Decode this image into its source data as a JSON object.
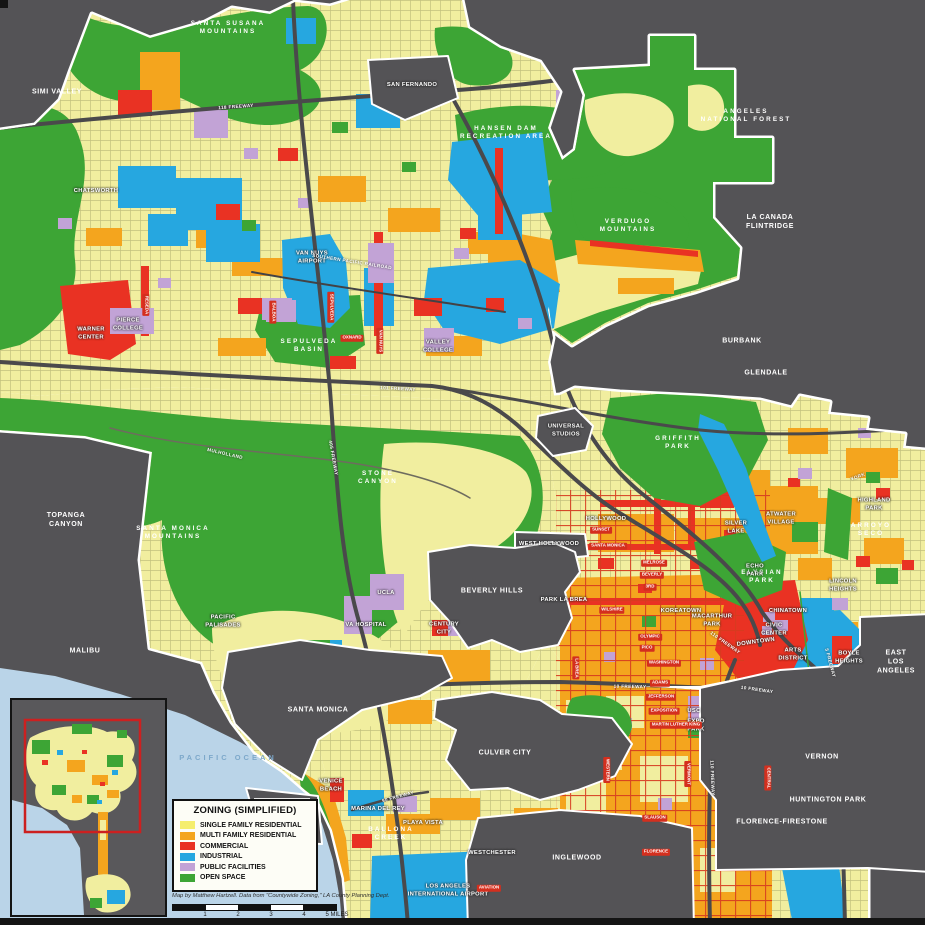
{
  "colors": {
    "background": "#545356",
    "single_family": "#f1ee9f",
    "multi_family": "#f4a51e",
    "commercial": "#e93223",
    "industrial": "#26a7e0",
    "public_facilities": "#c2a3d6",
    "open_space": "#3da535",
    "ocean": "#bad4e8",
    "boundary": "#ffffff",
    "freeway": "#4a494b",
    "inset_viewport": "#cc2020"
  },
  "legend": {
    "title": "ZONING (SIMPLIFIED)",
    "items": [
      {
        "label": "SINGLE FAMILY RESIDENTIAL",
        "color": "#f5ee6e"
      },
      {
        "label": "MULTI FAMILY RESIDENTIAL",
        "color": "#f4a51e"
      },
      {
        "label": "COMMERCIAL",
        "color": "#e93223"
      },
      {
        "label": "INDUSTRIAL",
        "color": "#26a7e0"
      },
      {
        "label": "PUBLIC FACILITIES",
        "color": "#c2a3d6"
      },
      {
        "label": "OPEN SPACE",
        "color": "#3da535"
      }
    ]
  },
  "credit": "Map by Matthew Hartzell. Data from \"Countywide Zoning,\" LA County Planning Dept.",
  "scalebar": {
    "ticks": [
      "1",
      "2",
      "3",
      "4",
      "5 MILES"
    ]
  },
  "map": {
    "labels": [
      {
        "t": "SIMI VALLEY",
        "x": 57,
        "y": 92,
        "c": "city"
      },
      {
        "t": "SAN FERNANDO",
        "x": 412,
        "y": 86,
        "c": "place"
      },
      {
        "t": "LA CANADA\nFLINTRIDGE",
        "x": 770,
        "y": 222,
        "c": "city"
      },
      {
        "t": "BURBANK",
        "x": 742,
        "y": 341,
        "c": "city"
      },
      {
        "t": "GLENDALE",
        "x": 766,
        "y": 373,
        "c": "city"
      },
      {
        "t": "TOPANGA\nCANYON",
        "x": 66,
        "y": 520,
        "c": "city"
      },
      {
        "t": "MALIBU",
        "x": 85,
        "y": 651,
        "c": "city"
      },
      {
        "t": "SANTA MONICA",
        "x": 318,
        "y": 710,
        "c": "city"
      },
      {
        "t": "CULVER CITY",
        "x": 505,
        "y": 753,
        "c": "city"
      },
      {
        "t": "INGLEWOOD",
        "x": 577,
        "y": 858,
        "c": "city"
      },
      {
        "t": "VERNON",
        "x": 822,
        "y": 757,
        "c": "city"
      },
      {
        "t": "HUNTINGTON PARK",
        "x": 828,
        "y": 800,
        "c": "city"
      },
      {
        "t": "FLORENCE-FIRESTONE",
        "x": 782,
        "y": 822,
        "c": "city"
      },
      {
        "t": "EAST\nLOS ANGELES",
        "x": 896,
        "y": 662,
        "c": "city"
      },
      {
        "t": "BEVERLY HILLS",
        "x": 492,
        "y": 591,
        "c": "city"
      },
      {
        "t": "WEST HOLLYWOOD",
        "x": 549,
        "y": 545,
        "c": "place"
      },
      {
        "t": "UNIVERSAL\nSTUDIOS",
        "x": 566,
        "y": 431,
        "c": "place"
      },
      {
        "t": "SANTA SUSANA\nMOUNTAINS",
        "x": 228,
        "y": 28,
        "c": "green"
      },
      {
        "t": "HANSEN DAM\nRECREATION AREA",
        "x": 506,
        "y": 133,
        "c": "green"
      },
      {
        "t": "ANGELES\nNATIONAL FOREST",
        "x": 746,
        "y": 116,
        "c": "green"
      },
      {
        "t": "VERDUGO\nMOUNTAINS",
        "x": 628,
        "y": 226,
        "c": "green"
      },
      {
        "t": "GRIFFITH\nPARK",
        "x": 678,
        "y": 443,
        "c": "green"
      },
      {
        "t": "SANTA MONICA\nMOUNTAINS",
        "x": 173,
        "y": 533,
        "c": "green"
      },
      {
        "t": "SEPULVEDA\nBASIN",
        "x": 309,
        "y": 346,
        "c": "green"
      },
      {
        "t": "STONE\nCANYON",
        "x": 378,
        "y": 478,
        "c": "green"
      },
      {
        "t": "ELYSIAN\nPARK",
        "x": 762,
        "y": 577,
        "c": "green"
      },
      {
        "t": "ARROYO\nSECO",
        "x": 871,
        "y": 530,
        "c": "green"
      },
      {
        "t": "BALLONA\nCREEK",
        "x": 391,
        "y": 834,
        "c": "green"
      },
      {
        "t": "PACIFIC OCEAN",
        "x": 228,
        "y": 758,
        "c": "ocean"
      },
      {
        "t": "CHATSWORTH",
        "x": 96,
        "y": 192,
        "c": "place"
      },
      {
        "t": "VAN NUYS\nAIRPORT",
        "x": 312,
        "y": 258,
        "c": "place"
      },
      {
        "t": "WARNER\nCENTER",
        "x": 91,
        "y": 334,
        "c": "place"
      },
      {
        "t": "PIERCE\nCOLLEGE",
        "x": 128,
        "y": 325,
        "c": "place"
      },
      {
        "t": "VALLEY\nCOLLEGE",
        "x": 438,
        "y": 347,
        "c": "place"
      },
      {
        "t": "PACIFIC\nPALISADES",
        "x": 223,
        "y": 622,
        "c": "place"
      },
      {
        "t": "UCLA",
        "x": 386,
        "y": 594,
        "c": "place"
      },
      {
        "t": "VA HOSPITAL",
        "x": 366,
        "y": 626,
        "c": "place"
      },
      {
        "t": "CENTURY\nCITY",
        "x": 444,
        "y": 629,
        "c": "place"
      },
      {
        "t": "HOLLYWOOD",
        "x": 606,
        "y": 520,
        "c": "place"
      },
      {
        "t": "SILVER\nLAKE",
        "x": 736,
        "y": 528,
        "c": "place"
      },
      {
        "t": "ATWATER\nVILLAGE",
        "x": 781,
        "y": 519,
        "c": "place"
      },
      {
        "t": "ECHO\nPARK",
        "x": 755,
        "y": 571,
        "c": "place"
      },
      {
        "t": "HIGHLAND\nPARK",
        "x": 874,
        "y": 505,
        "c": "place"
      },
      {
        "t": "LINCOLN\nHEIGHTS",
        "x": 843,
        "y": 586,
        "c": "place"
      },
      {
        "t": "KOREATOWN",
        "x": 681,
        "y": 612,
        "c": "place"
      },
      {
        "t": "MACARTHUR\nPARK",
        "x": 712,
        "y": 621,
        "c": "place"
      },
      {
        "t": "PARK LA BREA",
        "x": 564,
        "y": 601,
        "c": "place"
      },
      {
        "t": "CIVIC\nCENTER",
        "x": 774,
        "y": 630,
        "c": "place"
      },
      {
        "t": "DOWNTOWN",
        "x": 756,
        "y": 643,
        "c": "place",
        "r": -8
      },
      {
        "t": "CHINATOWN",
        "x": 788,
        "y": 612,
        "c": "place"
      },
      {
        "t": "ARTS\nDISTRICT",
        "x": 793,
        "y": 655,
        "c": "place"
      },
      {
        "t": "BOYLE\nHEIGHTS",
        "x": 849,
        "y": 658,
        "c": "place"
      },
      {
        "t": "USC",
        "x": 694,
        "y": 712,
        "c": "place"
      },
      {
        "t": "EXPO\nPARK",
        "x": 696,
        "y": 726,
        "c": "place"
      },
      {
        "t": "VENICE\nBEACH",
        "x": 331,
        "y": 786,
        "c": "place"
      },
      {
        "t": "MARINA DEL REY",
        "x": 378,
        "y": 810,
        "c": "place"
      },
      {
        "t": "PLAYA VISTA",
        "x": 423,
        "y": 824,
        "c": "place"
      },
      {
        "t": "WESTCHESTER",
        "x": 492,
        "y": 854,
        "c": "place"
      },
      {
        "t": "LOS ANGELES\nINTERNATIONAL AIRPORT",
        "x": 448,
        "y": 891,
        "c": "place"
      },
      {
        "t": "118 FREEWAY",
        "x": 236,
        "y": 107,
        "c": "road",
        "r": -4
      },
      {
        "t": "SOUTHERN PACIFIC RAILROAD",
        "x": 352,
        "y": 262,
        "c": "road",
        "r": 9
      },
      {
        "t": "101 FREEWAY",
        "x": 398,
        "y": 389,
        "c": "road",
        "r": 3
      },
      {
        "t": "405 FREEWAY",
        "x": 333,
        "y": 458,
        "c": "road",
        "r": 80
      },
      {
        "t": "MULHOLLAND",
        "x": 225,
        "y": 454,
        "c": "road",
        "r": 13
      },
      {
        "t": "10 FREEWAY",
        "x": 630,
        "y": 687,
        "c": "road",
        "r": 1
      },
      {
        "t": "10 FREEWAY",
        "x": 757,
        "y": 690,
        "c": "road",
        "r": 8
      },
      {
        "t": "110 FREEWAY",
        "x": 725,
        "y": 643,
        "c": "road",
        "r": 35
      },
      {
        "t": "110 FREEWAY",
        "x": 712,
        "y": 778,
        "c": "road",
        "r": 88
      },
      {
        "t": "5 FREEWAY",
        "x": 830,
        "y": 663,
        "c": "road",
        "r": 75
      },
      {
        "t": "90 FREEWAY",
        "x": 398,
        "y": 797,
        "c": "road",
        "r": -15
      },
      {
        "t": "YORK",
        "x": 858,
        "y": 477,
        "c": "road",
        "r": -20
      },
      {
        "t": "OXNARD",
        "x": 352,
        "y": 338,
        "c": "street"
      },
      {
        "t": "BALBOA",
        "x": 273,
        "y": 312,
        "c": "street",
        "r": 90
      },
      {
        "t": "SEPULVEDA",
        "x": 331,
        "y": 307,
        "c": "street",
        "r": 90
      },
      {
        "t": "VAN NUYS",
        "x": 380,
        "y": 341,
        "c": "street",
        "r": 90
      },
      {
        "t": "RESEDA",
        "x": 146,
        "y": 305,
        "c": "street",
        "r": 90
      },
      {
        "t": "SUNSET",
        "x": 601,
        "y": 530,
        "c": "street"
      },
      {
        "t": "SANTA MONICA",
        "x": 608,
        "y": 546,
        "c": "street"
      },
      {
        "t": "MELROSE",
        "x": 654,
        "y": 563,
        "c": "street"
      },
      {
        "t": "BEVERLY",
        "x": 652,
        "y": 575,
        "c": "street"
      },
      {
        "t": "3RD",
        "x": 650,
        "y": 587,
        "c": "street"
      },
      {
        "t": "WILSHIRE",
        "x": 612,
        "y": 610,
        "c": "street"
      },
      {
        "t": "OLYMPIC",
        "x": 650,
        "y": 637,
        "c": "street"
      },
      {
        "t": "PICO",
        "x": 647,
        "y": 648,
        "c": "street"
      },
      {
        "t": "WASHINGTON",
        "x": 664,
        "y": 663,
        "c": "street"
      },
      {
        "t": "ADAMS",
        "x": 660,
        "y": 683,
        "c": "street"
      },
      {
        "t": "JEFFERSON",
        "x": 661,
        "y": 697,
        "c": "street"
      },
      {
        "t": "EXPOSITION",
        "x": 664,
        "y": 711,
        "c": "street"
      },
      {
        "t": "MARTIN LUTHER KING",
        "x": 676,
        "y": 725,
        "c": "street"
      },
      {
        "t": "SLAUSON",
        "x": 655,
        "y": 818,
        "c": "street"
      },
      {
        "t": "FLORENCE",
        "x": 656,
        "y": 852,
        "c": "street"
      },
      {
        "t": "WESTERN",
        "x": 607,
        "y": 770,
        "c": "street",
        "r": 90
      },
      {
        "t": "VERMONT",
        "x": 688,
        "y": 774,
        "c": "street",
        "r": 90
      },
      {
        "t": "CENTRAL",
        "x": 768,
        "y": 778,
        "c": "street",
        "r": 90
      },
      {
        "t": "LA BREA",
        "x": 576,
        "y": 668,
        "c": "street",
        "r": 90
      },
      {
        "t": "AVIATION",
        "x": 489,
        "y": 888,
        "c": "street"
      }
    ]
  }
}
